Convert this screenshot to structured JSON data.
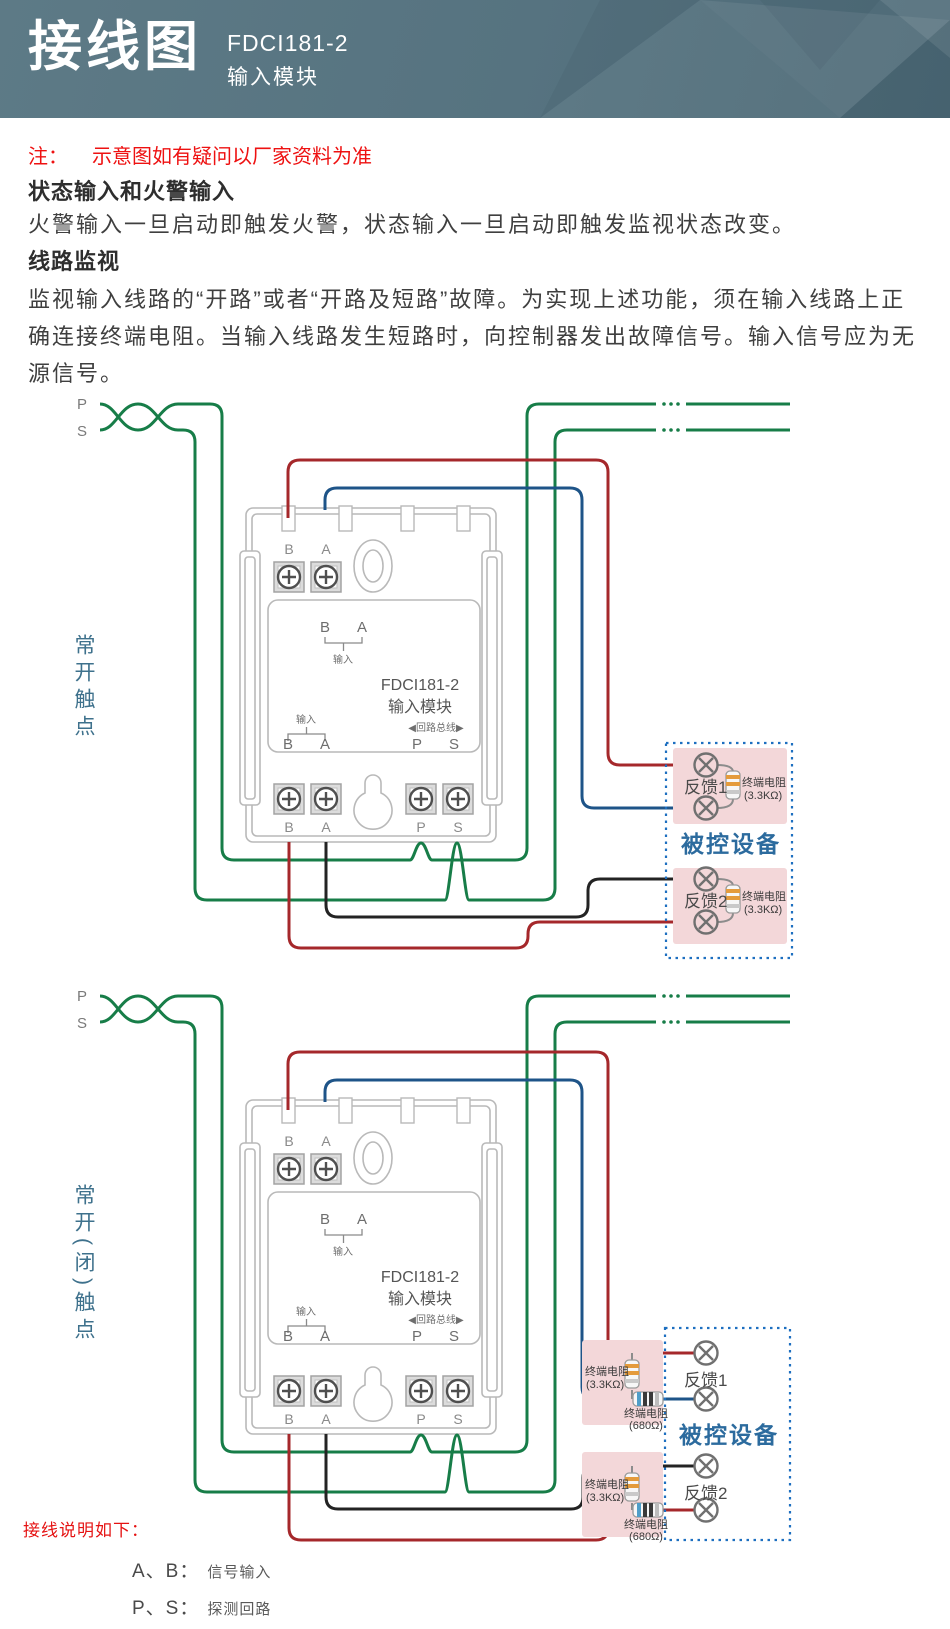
{
  "header": {
    "title": "接线图",
    "model": "FDCI181-2",
    "subtitle": "输入模块"
  },
  "intro": {
    "note_label": "注：",
    "note_text": "示意图如有疑问以厂家资料为准",
    "heading1": "状态输入和火警输入",
    "para1": "火警输入一旦启动即触发火警，状态输入一旦启动即触发监视状态改变。",
    "heading2": "线路监视",
    "para2": "监视输入线路的“开路”或者“开路及短路”故障。为实现上述功能，须在输入线路上正确连接终端电阻。当输入线路发生短路时，向控制器发出故障信号。输入信号应为无源信号。"
  },
  "bus": {
    "p": "P",
    "s": "S"
  },
  "module": {
    "terminal_b": "B",
    "terminal_a": "A",
    "terminal_p": "P",
    "terminal_s": "S",
    "input_label": "输入",
    "name_line1": "FDCI181-2",
    "name_line2": "输入模块",
    "loop_bus_label": "◀回路总线▶"
  },
  "diagram1": {
    "side_label": "常开触点",
    "device": {
      "title": "被控设备",
      "feedback1": "反馈1",
      "feedback2": "反馈2",
      "resistor_name": "终端电阻",
      "resistor_value": "(3.3KΩ)"
    }
  },
  "diagram2": {
    "side_label": "常开(闭)触点",
    "device": {
      "title": "被控设备",
      "feedback1": "反馈1",
      "feedback2": "反馈2",
      "res_33k_name": "终端电阻",
      "res_33k_value": "(3.3KΩ)",
      "res_680_name": "终端电阻",
      "res_680_value": "(680Ω)"
    }
  },
  "legend": {
    "title": "接线说明如下：",
    "item1_term": "A、B：",
    "item1_desc": "信号输入",
    "item2_term": "P、S：",
    "item2_desc": "探测回路"
  },
  "colors": {
    "wire_green": "#177d48",
    "wire_red": "#a5282b",
    "wire_blue": "#1e5488",
    "wire_black": "#232323",
    "device_box_blue": "#1d6fc0",
    "pink_panel": "#f3d7d9",
    "note_red": "#ee1111",
    "side_label_teal": "#3e718c",
    "device_title_blue": "#2c6b9e",
    "header_bg": "#567380"
  }
}
